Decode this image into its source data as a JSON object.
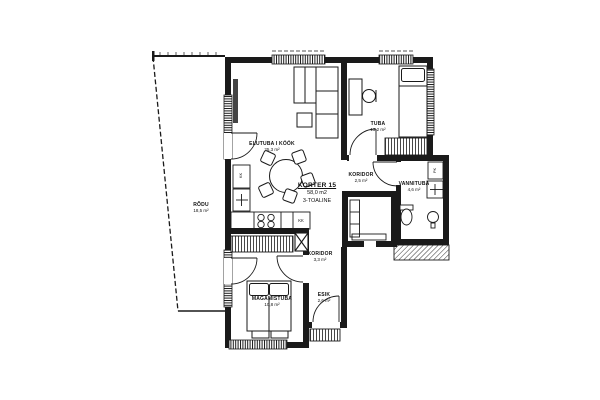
{
  "plan_title": {
    "apartment": "KORTER 15",
    "total_area": "58,0 m2",
    "rooms_count": "3-TOALINE"
  },
  "rooms": {
    "living": {
      "name": "ELUTUBA I KÖÖK",
      "area": "25,3 m²"
    },
    "tuba": {
      "name": "TUBA",
      "area": "13,2 m²"
    },
    "koridor_upper": {
      "name": "KORIDOR",
      "area": "2,5 m²"
    },
    "vannituba": {
      "name": "VANNITUBA",
      "area": "4,6 m²"
    },
    "koridor_lower": {
      "name": "KORIDOR",
      "area": "3,3 m²"
    },
    "magamistuba": {
      "name": "MAGAMISTUBA",
      "area": "10,8 m²"
    },
    "esik": {
      "name": "ESIK",
      "area": "2,6 m²"
    },
    "rodu": {
      "name": "RÕDU",
      "area": "18,5 m²"
    }
  },
  "fixtures": {
    "fridge_label": "KK",
    "counter_label": "KK",
    "washer_label": "PK"
  },
  "colors": {
    "wall": "#1a1a1a",
    "line": "#1a1a1a",
    "background": "#ffffff"
  }
}
